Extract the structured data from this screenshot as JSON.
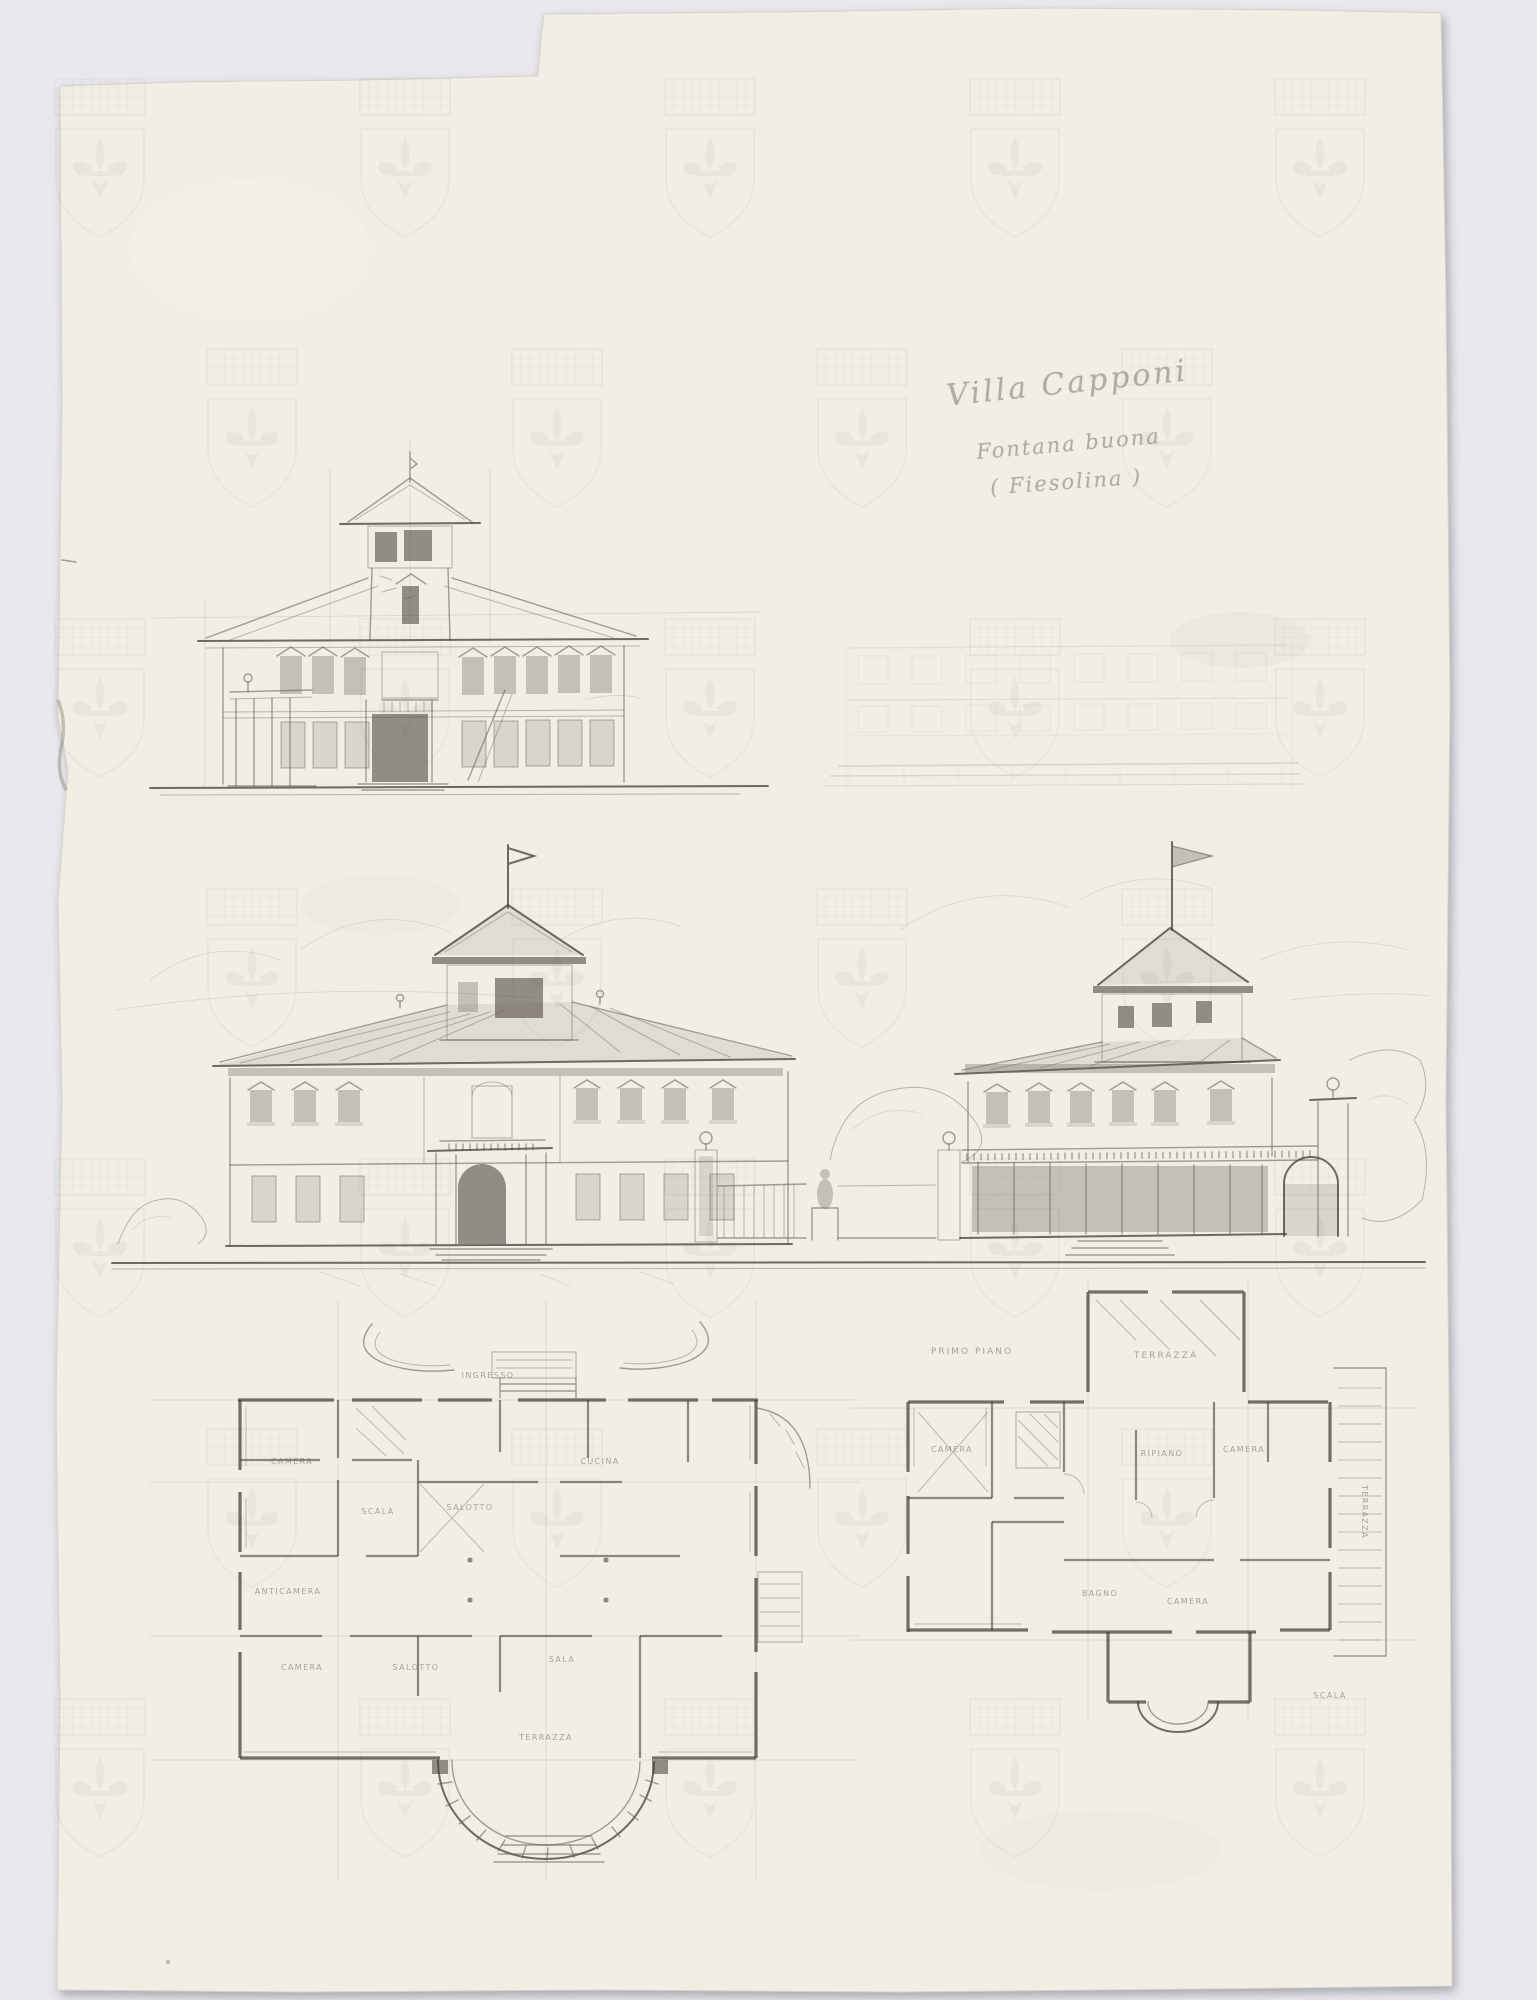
{
  "inscription": {
    "line1": "Villa Capponi",
    "line2": "Fontana buona",
    "line3": "( Fiesolina )"
  },
  "colors": {
    "background": "#e9e9ed",
    "paper": "#f1eee6",
    "pencil": "#6b6459",
    "pencil_dark": "#423d35",
    "watermark": "#938a76",
    "inscription_ink": "#7d766a"
  },
  "plans": {
    "ground_floor": {
      "labels": [
        {
          "text": "INGRESSO",
          "x": 488,
          "y": 1378
        },
        {
          "text": "CAMERA",
          "x": 292,
          "y": 1464
        },
        {
          "text": "SCALA",
          "x": 378,
          "y": 1514
        },
        {
          "text": "SALOTTO",
          "x": 470,
          "y": 1510
        },
        {
          "text": "CUCINA",
          "x": 600,
          "y": 1464
        },
        {
          "text": "ANTICAMERA",
          "x": 288,
          "y": 1594
        },
        {
          "text": "CAMERA",
          "x": 302,
          "y": 1670
        },
        {
          "text": "SALOTTO",
          "x": 416,
          "y": 1670
        },
        {
          "text": "SALA",
          "x": 562,
          "y": 1662
        },
        {
          "text": "TERRAZZA",
          "x": 546,
          "y": 1740
        }
      ]
    },
    "first_floor": {
      "labels": [
        {
          "text": "PRIMO PIANO",
          "x": 972,
          "y": 1354,
          "big": true
        },
        {
          "text": "TERRAZZA",
          "x": 1166,
          "y": 1358,
          "big": true
        },
        {
          "text": "CAMERA",
          "x": 952,
          "y": 1452
        },
        {
          "text": "RIPIANO",
          "x": 1162,
          "y": 1456
        },
        {
          "text": "CAMERA",
          "x": 1244,
          "y": 1452
        },
        {
          "text": "BAGNO",
          "x": 1100,
          "y": 1596
        },
        {
          "text": "CAMERA",
          "x": 1188,
          "y": 1604
        },
        {
          "text": "TERRAZZA",
          "x": 1362,
          "y": 1512,
          "rot": 90
        },
        {
          "text": "SCALA",
          "x": 1330,
          "y": 1698
        }
      ]
    }
  }
}
